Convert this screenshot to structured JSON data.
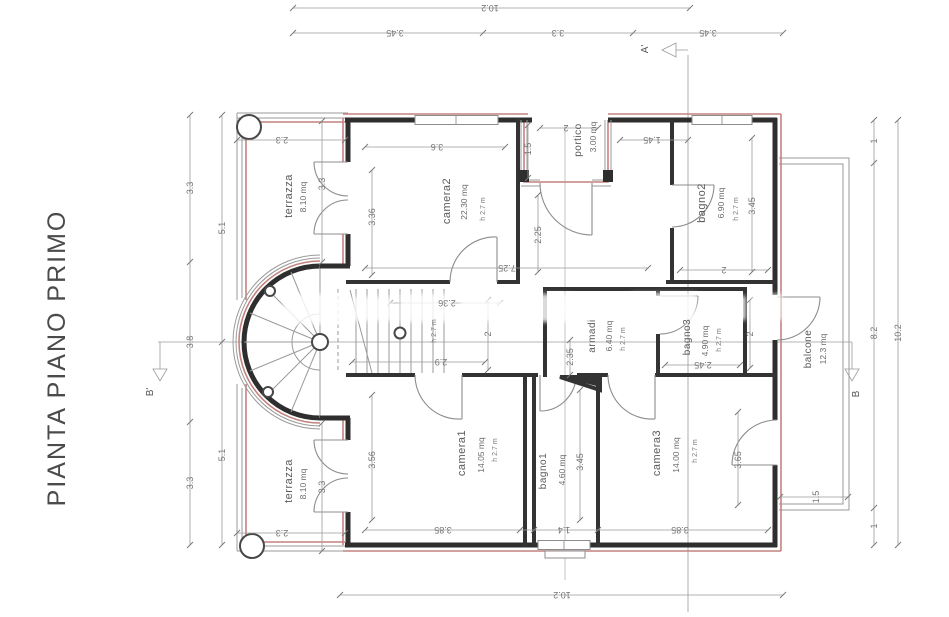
{
  "title": "PIANTA PIANO PRIMO",
  "rooms": {
    "terrazza_top": {
      "name": "terrazza",
      "area": "8.10 mq"
    },
    "camera2": {
      "name": "camera2",
      "area": "22.30 mq",
      "height": "h 2.7 m"
    },
    "portico": {
      "name": "portico",
      "area": "3.00 mq"
    },
    "bagno2": {
      "name": "bagno2",
      "area": "6.90 mq",
      "height": "h 2.7 m"
    },
    "armadi": {
      "name": "armadi",
      "area": "6.40 mq",
      "height": "h 2.7 m"
    },
    "bagno3": {
      "name": "bagno3",
      "area": "4.90 mq",
      "height": "h 2.7 m"
    },
    "corridoio": {
      "height": "h 2.7 m"
    },
    "camera1": {
      "name": "camera1",
      "area": "14.05 mq",
      "height": "h 2.7 m"
    },
    "bagno1": {
      "name": "bagno1",
      "area": "4.60 mq"
    },
    "camera3": {
      "name": "camera3",
      "area": "14.00 mq",
      "height": "h 2.7 m"
    },
    "terrazza_bottom": {
      "name": "terrazza",
      "area": "8.10 mq"
    },
    "balcone": {
      "name": "balcone",
      "area": "12.3 mq"
    }
  },
  "dims": {
    "top_total": "10.2",
    "top_left": "3.45",
    "top_mid": "3.3",
    "top_right": "3.45",
    "left_out_top": "3.3",
    "left_out_mid": "3.8",
    "left_out_bot": "3.3",
    "left_in_top": "5.1",
    "left_in_bot": "5.1",
    "right_top": "1",
    "right_mid": "8.2",
    "right_bot": "1",
    "right_total": "10.2",
    "bottom_total": "10.2",
    "terr_top_w": "2.3",
    "terr_top_h": "3.3",
    "terr_bot_w": "2.3",
    "terr_bot_h": "3.3",
    "camera2_w": "3.6",
    "camera2_h": "3.36",
    "hall_w": "7.25",
    "hall_h": "2.25",
    "portico_d": "1.5",
    "portico_w": "2",
    "portico_side": "1.45",
    "bagno2_h": "3.45",
    "bagno2_w": "2",
    "corr_top": "2.36",
    "corr_bot": "2.9",
    "corr_r": "2",
    "armadi_w": "2.35",
    "bagno3_w": "2.45",
    "strip_w": "2",
    "camera1_h": "3.56",
    "camera1_w": "3.85",
    "bagno1_w": "1.4",
    "bagno1_h": "3.45",
    "camera3_w": "3.85",
    "camera3_h": "3.65",
    "balcone_w": "1.5"
  },
  "sections": {
    "a_prime": "A'",
    "b_prime": "B'",
    "b": "B"
  },
  "colors": {
    "wall": "#2e2e2e",
    "accent": "#c4827e",
    "line": "#9a9a9a",
    "text": "#737373"
  }
}
